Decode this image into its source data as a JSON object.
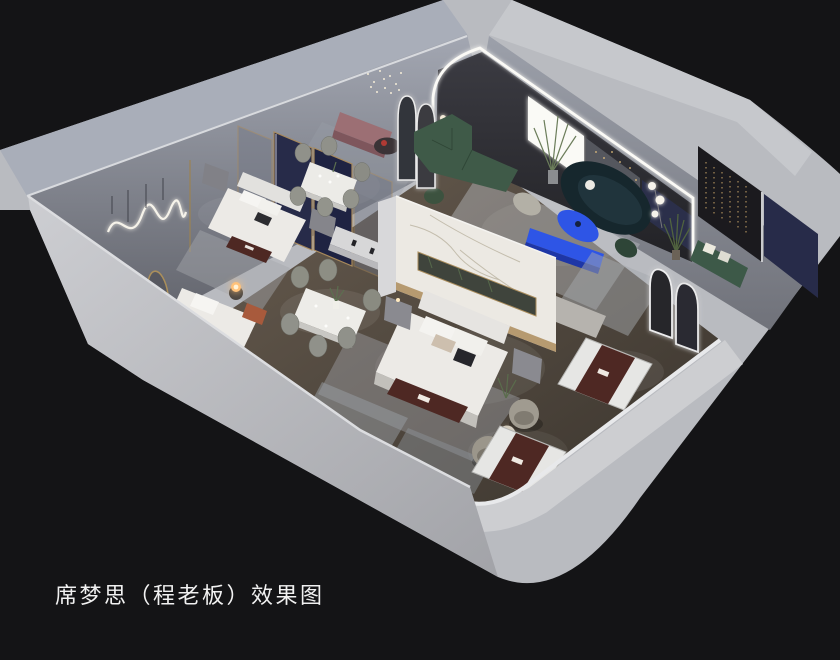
{
  "caption": {
    "text": "席梦思（程老板）效果图"
  },
  "palette": {
    "background": "#141416",
    "wall_light": "#b9bbc0",
    "wall_top_cool": "#a9aeb9",
    "wall_top_bright": "#c6c8cc",
    "marble": "#ece9e3",
    "gold": "#ad8c5c",
    "navy_panel": "#272b49",
    "green_sofa": "#3f5a48",
    "teal_sofa": "#16272d",
    "cobalt": "#2e55e6",
    "maroon_runner": "#4e2823",
    "bed_white": "#eceae6",
    "accent_wall_dark": "#1b1a1e",
    "warm_light": "#ffc27a",
    "led_white": "#fbfaf6"
  },
  "scene": {
    "type": "3d-interior-render",
    "objects": [
      "mattress showroom cutaway floor plan",
      "bedroom display with navy gold partitions",
      "double bed with maroon brand runner",
      "single bed with glowing bedside lamp",
      "marble feature partition with gold trim",
      "two marble dining sets with chairs",
      "lounge with arched LED wall and window",
      "green sectional sofa",
      "dark teal curved sofa",
      "cobalt blue oval coffee table and console",
      "dark accent wall with string lights",
      "arched LED floor mirrors",
      "mattress floor displays with maroon runners",
      "grey barrel swivel chairs",
      "wavy neon wall light",
      "crystal string chandelier"
    ]
  }
}
